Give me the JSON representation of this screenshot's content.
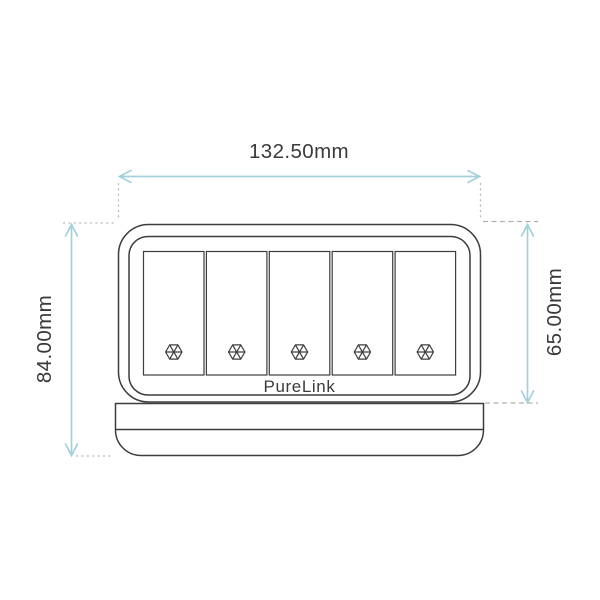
{
  "drawing": {
    "brand": "PureLink",
    "dimensions": {
      "width": {
        "label": "132.50mm"
      },
      "overall_height": {
        "label": "84.00mm"
      },
      "panel_height": {
        "label": "65.00mm"
      }
    },
    "panel": {
      "button_count": 5,
      "button_icon": "hex-wheel-icon"
    },
    "colors": {
      "dimension_line": "#A2D1DC",
      "extension_line": "#B8B8B8",
      "outline": "#3D3D3D",
      "label_text": "#3A3A3A",
      "background": "#FFFFFF"
    }
  }
}
